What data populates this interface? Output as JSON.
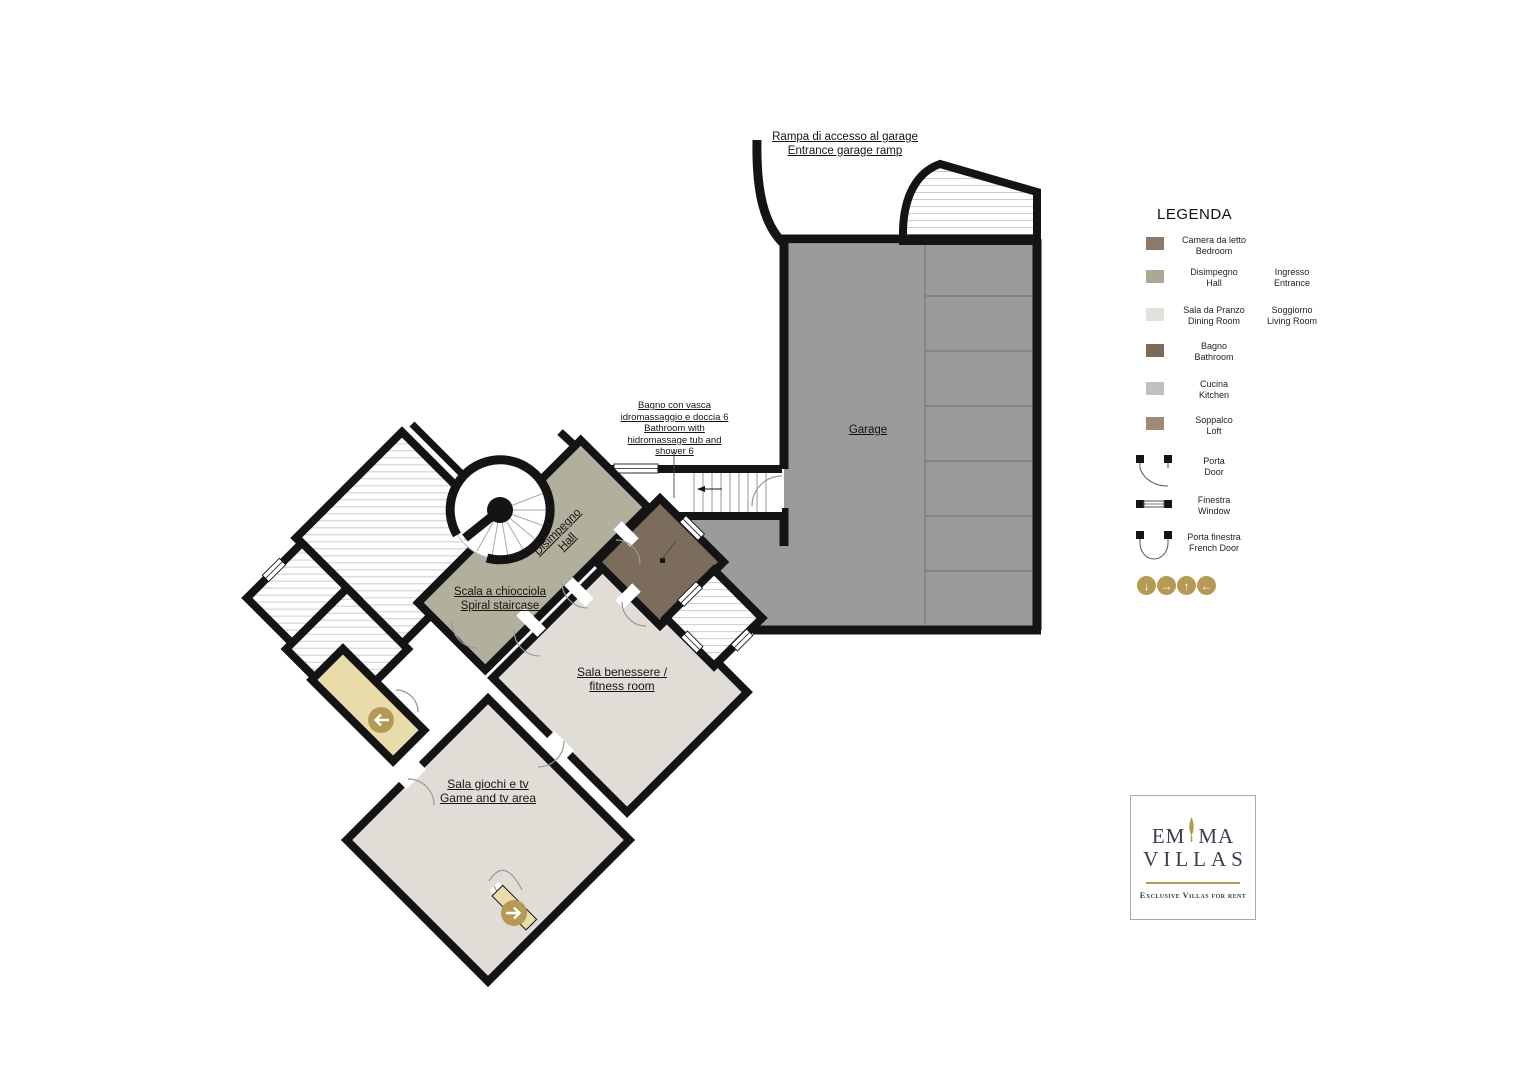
{
  "colors": {
    "wall": "#141414",
    "garage_gray": "#9b9b9b",
    "divider_gray": "#787878",
    "hall_green": "#b2af9c",
    "bathroom_brown": "#7c6c5d",
    "room_light": "#e0dcd6",
    "vestibule_tan": "#e9dcab",
    "nav_gold": "#b49a55",
    "hatch_line": "#cccccc"
  },
  "plan": {
    "ramp": {
      "label_it": "Rampa di accesso al garage",
      "label_en": "Entrance garage ramp"
    },
    "garage": {
      "label": "Garage"
    },
    "bathroom6": {
      "line1": "Bagno con vasca",
      "line2": "idromassaggio e doccia 6",
      "line3": "Bathroom with",
      "line4": "hidromassage tub and",
      "line5": "shower 6"
    },
    "hall": {
      "label_it": "Disimpegno",
      "label_en": "Hall"
    },
    "spiral_staircase": {
      "label_it": "Scala a chiocciola",
      "label_en": "Spiral staircase"
    },
    "fitness": {
      "label_it": "Sala benessere /",
      "label_en": "fitness room"
    },
    "game": {
      "label_it": "Sala giochi e tv",
      "label_en": "Game and tv area"
    },
    "nav_markers": [
      {
        "name": "left",
        "glyph": "←"
      },
      {
        "name": "right",
        "glyph": "→"
      }
    ]
  },
  "legend": {
    "title": "LEGENDA",
    "rows": [
      {
        "swatch": "#8b7a6b",
        "it": "Camera da letto",
        "en": "Bedroom",
        "col2_it": "",
        "col2_en": ""
      },
      {
        "swatch": "#aba894",
        "it": "Disimpegno",
        "en": "Hall",
        "col2_it": "Ingresso",
        "col2_en": "Entrance"
      },
      {
        "swatch": "#e4e0da",
        "it": "Sala da Pranzo",
        "en": "Dining Room",
        "col2_it": "Soggiorno",
        "col2_en": "Living Room"
      },
      {
        "swatch": "#7c6a5b",
        "it": "Bagno",
        "en": "Bathroom",
        "col2_it": "",
        "col2_en": ""
      },
      {
        "swatch": "#c2bfbd",
        "it": "Cucina",
        "en": "Kitchen",
        "col2_it": "",
        "col2_en": ""
      },
      {
        "swatch": "#a18a75",
        "it": "Soppalco",
        "en": "Loft",
        "col2_it": "",
        "col2_en": ""
      }
    ],
    "symbols": [
      {
        "icon": "door-icon",
        "it": "Porta",
        "en": "Door"
      },
      {
        "icon": "window-icon",
        "it": "Finestra",
        "en": "Window"
      },
      {
        "icon": "french-door-icon",
        "it": "Porta finestra",
        "en": "French Door"
      }
    ],
    "nav_arrows": [
      {
        "name": "down",
        "glyph": "↓"
      },
      {
        "name": "right",
        "glyph": "→"
      },
      {
        "name": "up",
        "glyph": "↑"
      },
      {
        "name": "left",
        "glyph": "←"
      }
    ]
  },
  "logo": {
    "word_part1": "EM",
    "word_part2": "MA",
    "word2": "VILLAS",
    "tagline": "Exclusive Villas for rent"
  }
}
